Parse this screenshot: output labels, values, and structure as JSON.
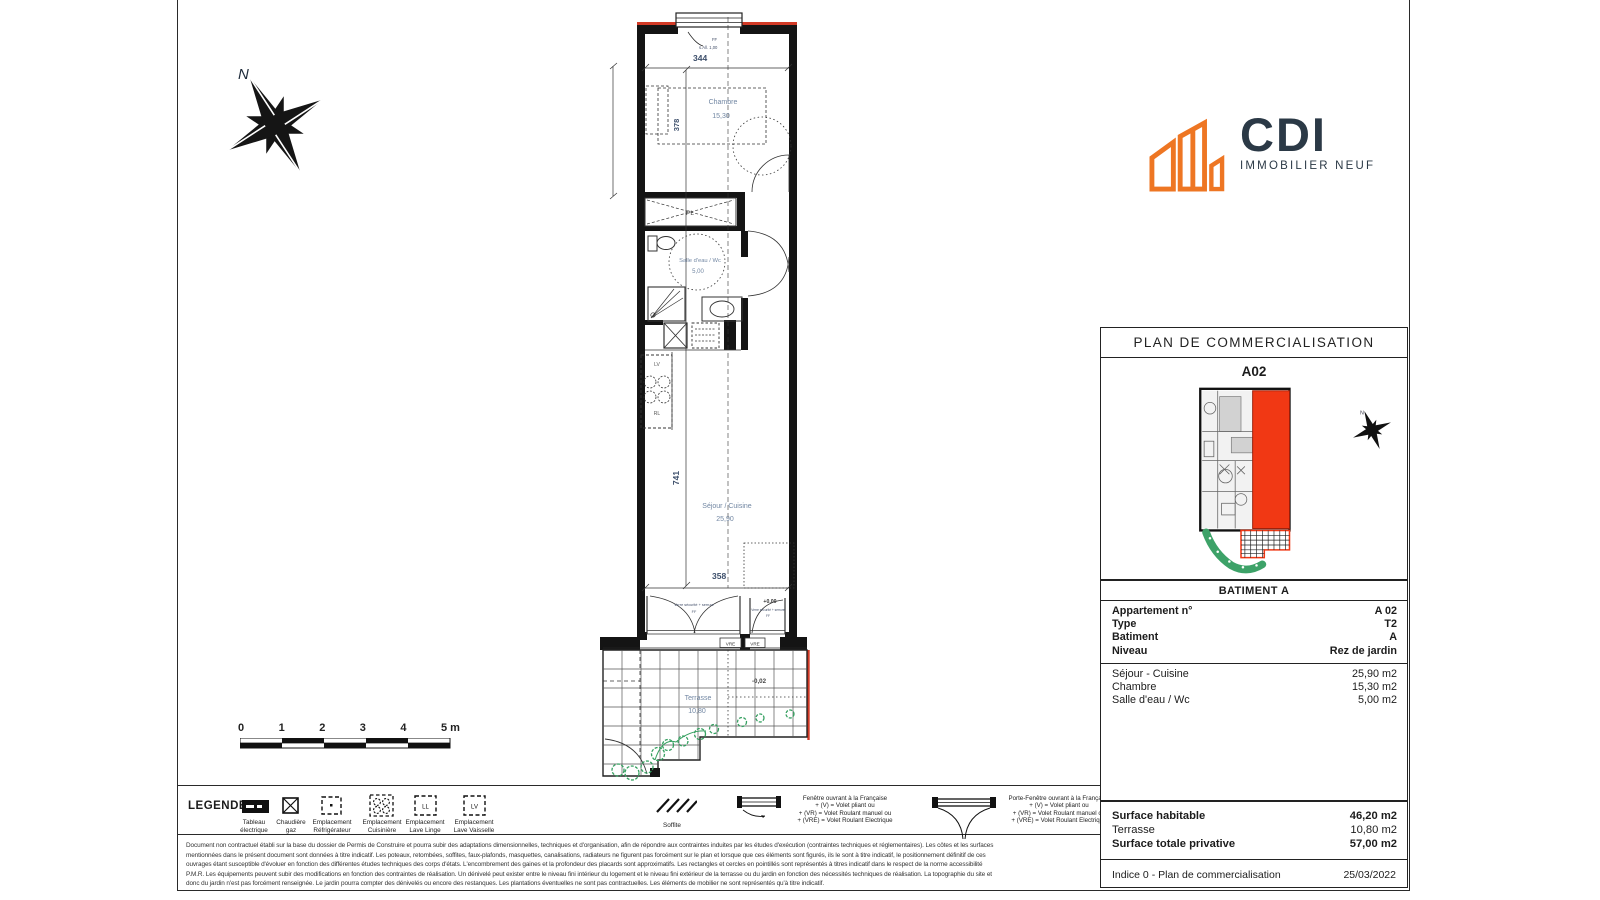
{
  "logo": {
    "name": "CDI",
    "tagline": "IMMOBILIER NEUF"
  },
  "compass": {
    "north": "N"
  },
  "scale_bar": {
    "ticks": [
      "0",
      "1",
      "2",
      "3",
      "4"
    ],
    "end_label": "5 m"
  },
  "plan": {
    "rooms": {
      "chambre": {
        "name": "Chambre",
        "area": "15,30"
      },
      "salle_eau": {
        "name": "Salle d'eau / Wc",
        "area": "5,00"
      },
      "sejour": {
        "name": "Séjour / Cuisine",
        "area": "25,90"
      },
      "terrasse": {
        "name": "Terrasse",
        "area": "10,80"
      }
    },
    "dimensions": {
      "top": "344",
      "chambre_depth": "378",
      "sejour_height": "741",
      "bottom": "358"
    },
    "levels": {
      "interior": "+0,00",
      "terrace": "-0,02"
    },
    "annotations": {
      "closet": "PL",
      "lv": "LV",
      "rl": "RL",
      "window_head": "FF",
      "sill": "s.All. 1,00",
      "glass_note": "Verre sécurité + serrure",
      "ff": "FF",
      "vre": "VRE"
    }
  },
  "side_panel": {
    "title": "PLAN DE COMMERCIALISATION",
    "unit": "A02",
    "building_header": "BATIMENT A",
    "identity": [
      {
        "label": "Appartement n°",
        "value": "A 02"
      },
      {
        "label": "Type",
        "value": "T2"
      },
      {
        "label": "Batiment",
        "value": "A"
      },
      {
        "label": "Niveau",
        "value": "Rez de jardin"
      }
    ],
    "room_areas": [
      {
        "label": "Séjour - Cuisine",
        "value": "25,90 m2"
      },
      {
        "label": "Chambre",
        "value": "15,30 m2"
      },
      {
        "label": "Salle d'eau / Wc",
        "value": "5,00 m2"
      }
    ],
    "summary": [
      {
        "label": "Surface habitable",
        "value": "46,20 m2"
      },
      {
        "label": "Terrasse",
        "value": "10,80 m2"
      },
      {
        "label": "Surface totale privative",
        "value": "57,00 m2"
      }
    ],
    "footer": {
      "label": "Indice 0 - Plan de commercialisation",
      "date": "25/03/2022"
    }
  },
  "legend": {
    "title": "LEGENDE:",
    "items": [
      {
        "line1": "Tableau",
        "line2": "électrique"
      },
      {
        "line1": "Chaudière",
        "line2": "gaz"
      },
      {
        "line1": "Emplacement",
        "line2": "Réfrigérateur"
      },
      {
        "line1": "Emplacement",
        "line2": "Cuisinière"
      },
      {
        "line1": "Emplacement",
        "line2": "Lave Linge",
        "glyph": "LL"
      },
      {
        "line1": "Emplacement",
        "line2": "Lave Vaisselle",
        "glyph": "LV"
      }
    ],
    "soffite": "Soffite",
    "window": {
      "title": "Fenêtre ouvrant à la Française",
      "l1": "+ (V) = Volet pliant ou",
      "l2": "+ (VR) = Volet Roulant manuel ou",
      "l3": "+ (VRE) = Volet Roulant Electrique"
    },
    "door_window": {
      "title": "Porte-Fenêtre ouvrant à la Française",
      "l1": "+ (V) = Volet pliant ou",
      "l2": "+ (VR) = Volet Roulant manuel ou",
      "l3": "+ (VRE) = Volet Roulant Electrique"
    }
  },
  "disclaimer": {
    "lines": [
      "Document non contractuel établi sur la base du dossier de Permis de Construire et pourra subir des adaptations dimensionnelles, techniques et d'organisation, afin de répondre aux contraintes induites par les études d'exécution (contraintes techniques et réglementaires). Les côtes et les surfaces",
      "mentionnées dans le présent document sont données à titre indicatif. Les poteaux, retombées, soffites, faux-plafonds, masquettes, canalisations, radiateurs ne figurent pas forcément sur le plan et lorsque que ces éléments sont figurés, ils le sont à titre indicatif, le positionnement définitif de ces",
      "ouvrages étant susceptible d'évoluer en fonction des différentes études techniques des corps d'états. L'encombrement des gaines et la profondeur des placards sont approximatifs. Les rectangles et cercles en pointillés sont représentés à titres indicatif dans le respect de la norme accessibilité",
      "P.M.R. Les équipements peuvent subir des modifications en fonction des contraintes de réalisation. Un dénivelé peut exister entre le niveau fini intérieur du logement et le niveau fini extérieur de la terrasse ou du jardin en fonction des nécessités techniques de réalisation. La topographie du site et",
      "donc du jardin n'est pas forcément renseignée. Le jardin pourra compter des dénivelés ou encore des restanques. Les plantations éventuelles ne sont pas contractuelles. Les éléments de mobilier ne sont représentés qu'à titre indicatif."
    ]
  },
  "colors": {
    "accent_orange": "#ee7623",
    "brand_navy": "#2b3946",
    "unit_red": "#f13814",
    "plant_green": "#35a060",
    "plan_red": "#d23a26"
  }
}
